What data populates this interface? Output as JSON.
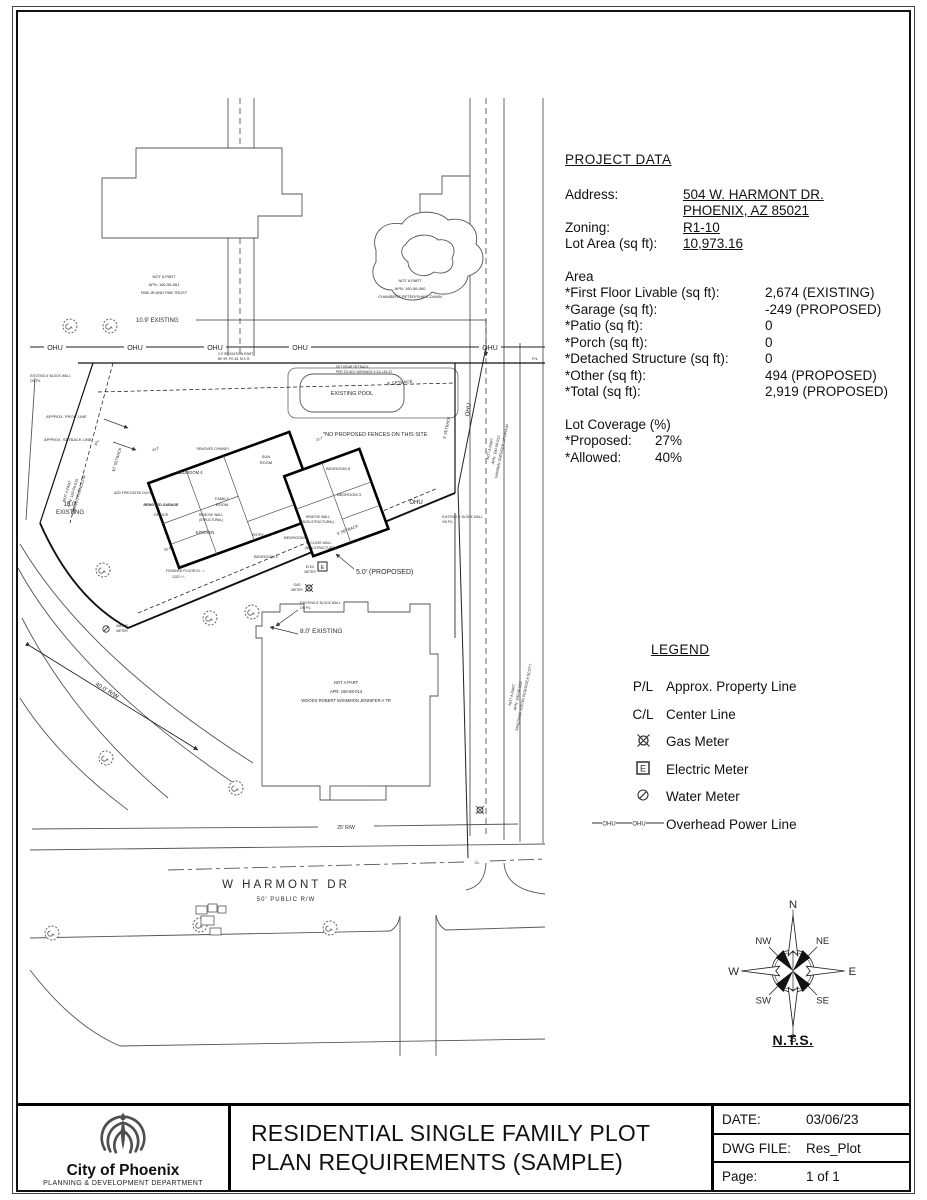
{
  "project_data": {
    "title": "PROJECT DATA",
    "address_label": "Address:",
    "address_line1": "504 W. HARMONT DR.",
    "address_line2": "PHOENIX, AZ 85021",
    "zoning_label": "Zoning:",
    "zoning_value": "R1-10",
    "lot_label": "Lot Area (sq ft):",
    "lot_value": "10,973.16",
    "area_title": "Area",
    "area_rows": [
      {
        "label": "*First Floor Livable (sq ft):",
        "value": "2,674 (EXISTING)"
      },
      {
        "label": "*Garage (sq ft):",
        "value": "-249 (PROPOSED)"
      },
      {
        "label": "*Patio (sq ft):",
        "value": "0"
      },
      {
        "label": "*Porch (sq ft):",
        "value": "0"
      },
      {
        "label": "*Detached Structure (sq ft):",
        "value": "0"
      },
      {
        "label": "*Other (sq ft):",
        "value": "494 (PROPOSED)"
      },
      {
        "label": "*Total (sq ft):",
        "value": "2,919 (PROPOSED)"
      }
    ],
    "coverage_title": "Lot Coverage (%)",
    "coverage_rows": [
      {
        "label": "*Proposed:",
        "value": "27%"
      },
      {
        "label": "*Allowed:",
        "value": "40%"
      }
    ]
  },
  "legend": {
    "title": "LEGEND",
    "pl_symbol": "P/L",
    "pl_label": "Approx. Property Line",
    "cl_symbol": "C/L",
    "cl_label": "Center Line",
    "gas_label": "Gas Meter",
    "electric_label": "Electric Meter",
    "electric_letter": "E",
    "water_label": "Water Meter",
    "ohu_label": "Overhead Power Line"
  },
  "compass": {
    "n": "N",
    "ne": "NE",
    "e": "E",
    "se": "SE",
    "s": "S",
    "sw": "SW",
    "w": "W",
    "nw": "NW",
    "nts": "N.T.S."
  },
  "title_block": {
    "org": "City of Phoenix",
    "dept": "PLANNING & DEVELOPMENT DEPARTMENT",
    "line1": "RESIDENTIAL SINGLE FAMILY PLOT",
    "line2": "PLAN REQUIREMENTS (SAMPLE)",
    "date_label": "DATE:",
    "date_value": "03/06/23",
    "dwg_label": "DWG FILE:",
    "dwg_value": "Res_Plot",
    "page_label": "Page:",
    "page_value": "1 of 1"
  },
  "plan": {
    "labels": {
      "ohu": "OHU",
      "pl": "P/L",
      "cl": "CL",
      "nap1_1": "NOT A PART",
      "nap1_2": "APN: 160-56-061",
      "nap1_3": "FBB JR AND PAB TRUST",
      "existing_109": "10.9' EXISTING",
      "nap2_1": "NOT A PART",
      "nap2_2": "APN: 160-56-060",
      "nap2_3": "CHAMBERS PETER/SHARI-DAWN",
      "irrig_1": "2.0' IRRIGATION ESMT",
      "irrig_2": "BK 99, PG 46, M.C.R.",
      "rear_sb_1": "SET REAR SETBACK",
      "rear_sb_2": "PER ZO ADJ VARIANCE # ZA-143-22",
      "setback_8": "8' SETBACK",
      "existing_pool": "EXISTING POOL",
      "no_fences": "*NO PROPOSED FENCES ON THIS SITE",
      "approx_prop": "APPROX. PROP. LINE",
      "approx_setback": "APPROX. SETBACK LINE",
      "nap3_1": "NOT A PART",
      "nap3_2": "APN: 160-56-015",
      "nap3_3": "MURILLO FRANCES M",
      "setback_10": "10' SETBACK",
      "setback_3": "3' SETBACK",
      "existing_100a": "10.0'",
      "existing_100b": "EXISTING",
      "nap4_1": "NOT A PART",
      "nap4_2": "APN: 160-56-012",
      "nap4_3": "HANSEN SPENCER J/POPIA M",
      "nap5_1": "NOT A PART",
      "nap5_2": "APN: 160-56-013",
      "nap5_3": "SPALDING JUSTIN W/JESSICA SCOTT",
      "bedroom1": "BEDROOM 1",
      "bedroom2": "BEDROOM 2",
      "bedroom3": "BEDROOM 3",
      "bedroom4": "BEDROOM 4",
      "bedroom5": "BEDROOM 5",
      "sun_1": "SUN",
      "sun_2": "ROOM",
      "family_1": "FAMILY",
      "family_2": "ROOM",
      "office": "OFFICE",
      "kitchen": "KITCHEN",
      "entry": "ENTRY",
      "removed_garage": "REMOVED GARAGE",
      "removed_chimney": "REMOVED CHIMNEY",
      "add_fire_door": "ADD FIRE-RATED DOOR",
      "remove_wall": "REMOVE WALL",
      "structural": "(STRUCTURAL)",
      "non_structural": "(NON-STRUCTURAL)",
      "close_wall": "CLOSE WALL",
      "elec": "ELEC",
      "gas": "GAS",
      "water": "WATER",
      "meter": "METER",
      "meter_e": "E",
      "ffe_1": "FINISHED FLOOR EL. =",
      "ffe_2": "1202 +/-",
      "block_wall": "EXISTING 6' BLOCK WALL",
      "on_pl": "ON P/L",
      "proposed_50": "5.0' (PROPOSED)",
      "existing_80": "8.0' EXISTING",
      "nap6_1": "NOT A PART",
      "nap6_2": "APN: 160-56-014",
      "nap6_3": "WOODS ROBERT M/SIMMON JENNIFER A TR",
      "rw_400": "40.0' R/W",
      "rw_25": "25' R/W",
      "street_name": "W HARMONT DR",
      "street_rw": "50' PUBLIC R/W",
      "dim1": "43.2'",
      "dim2": "33.4'",
      "dim3": "21.7'"
    }
  }
}
